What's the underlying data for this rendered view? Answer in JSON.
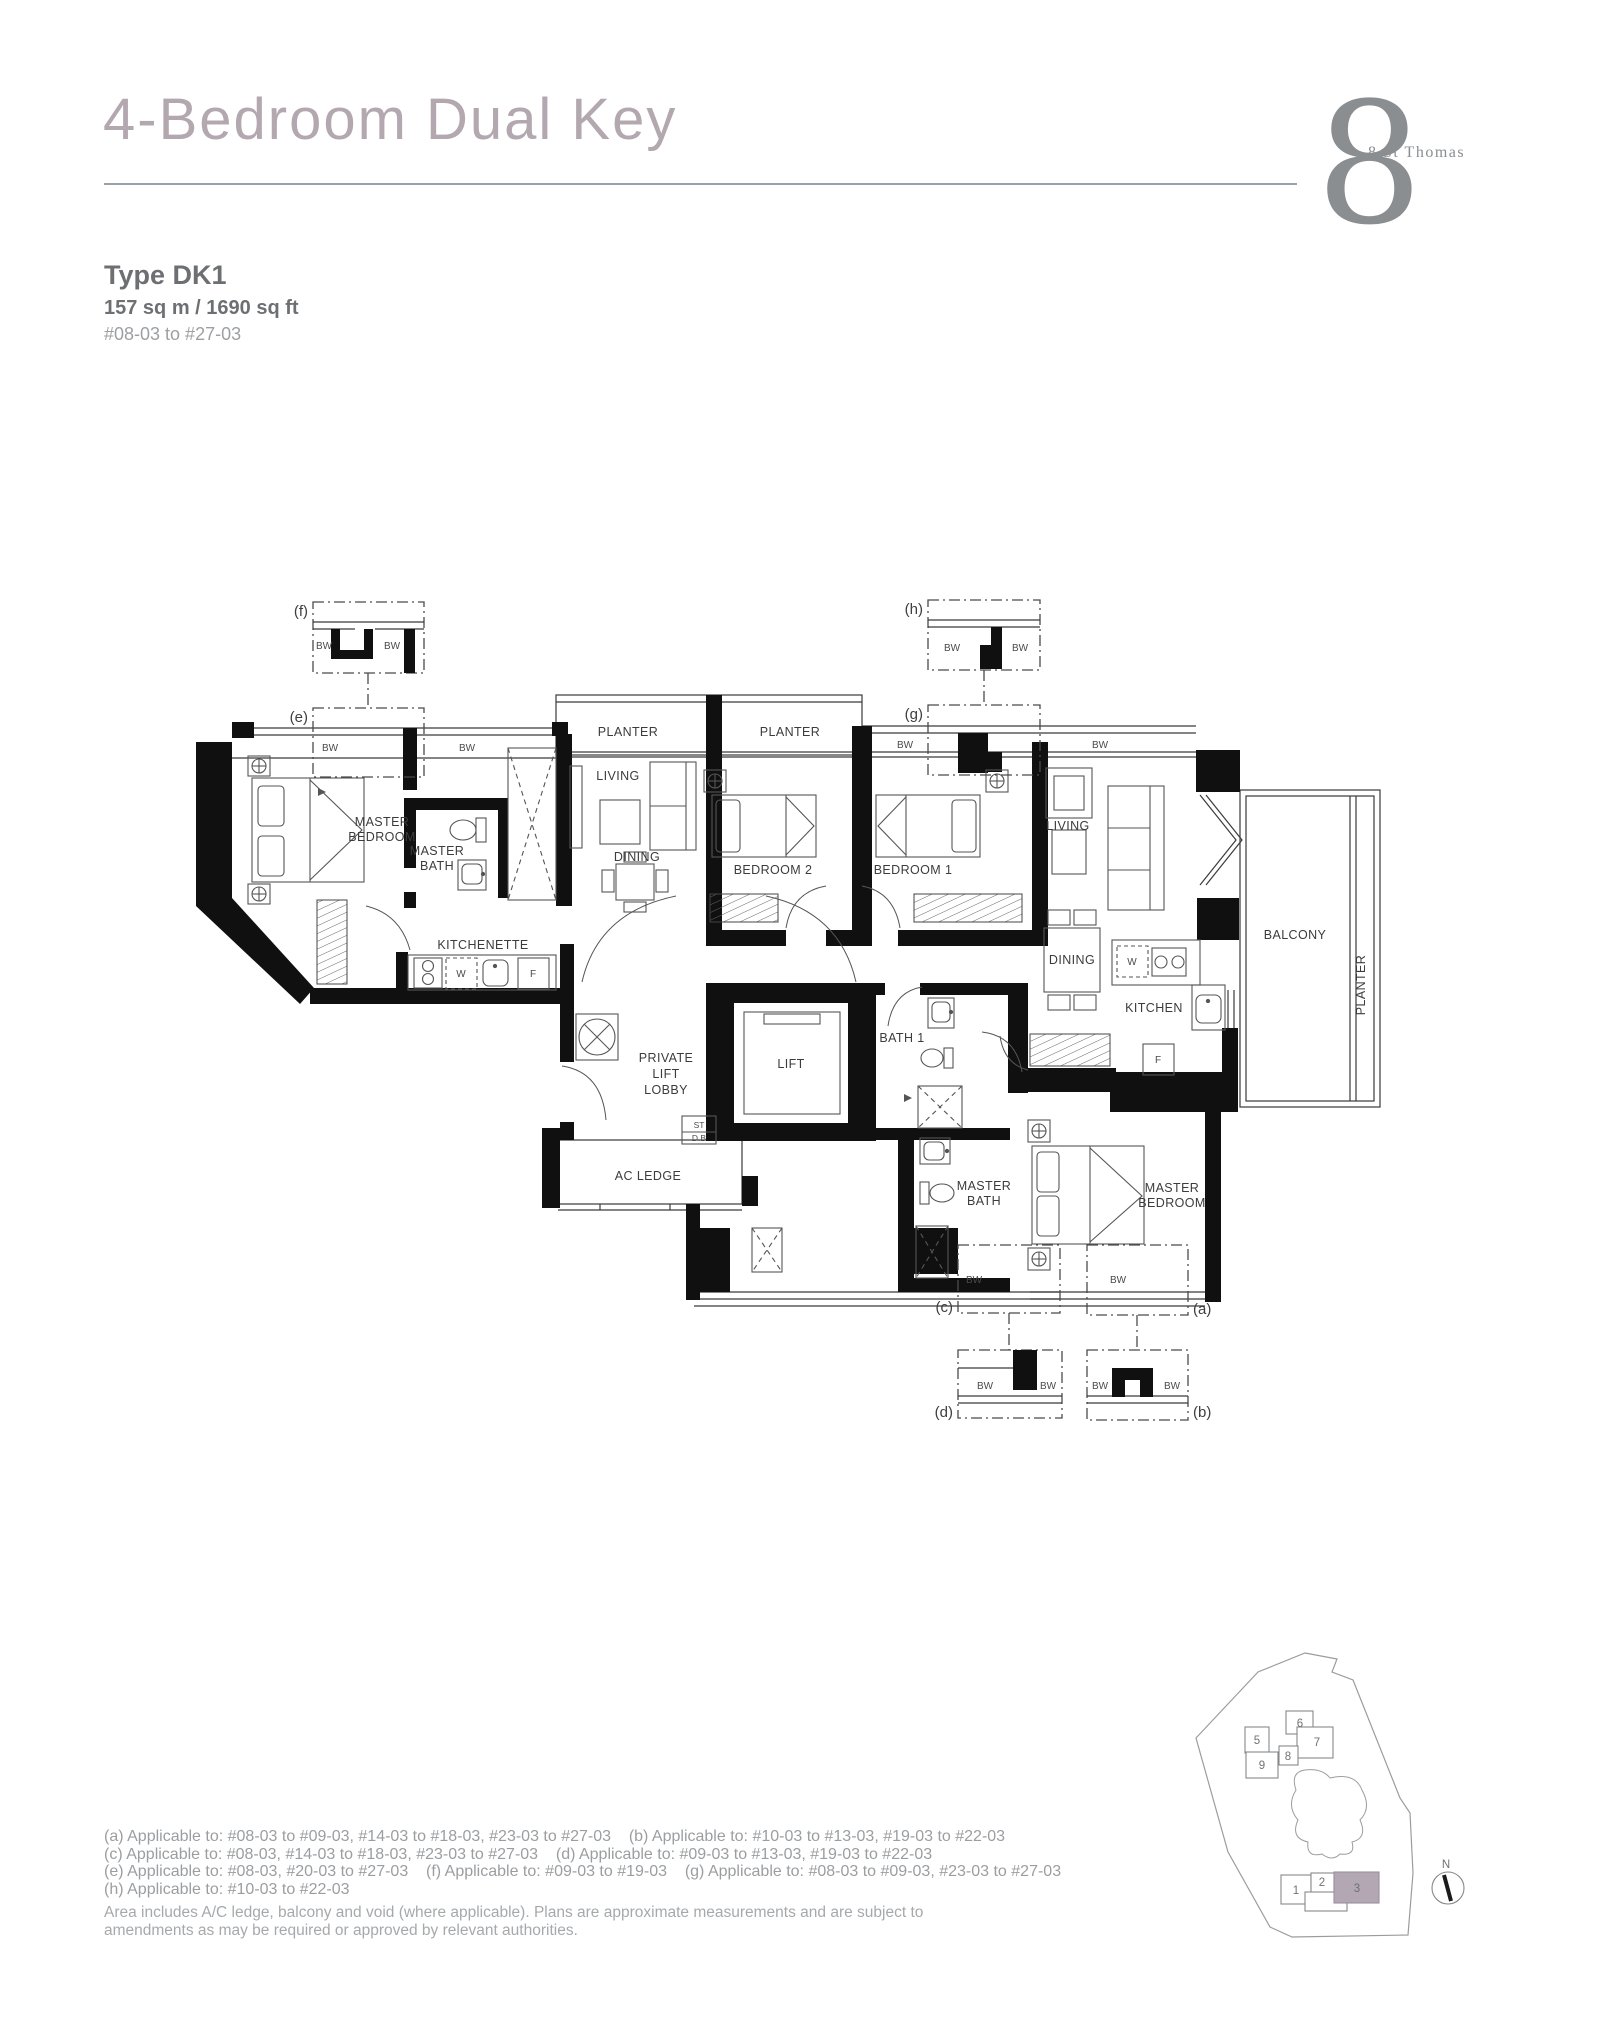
{
  "colors": {
    "title": "#b3a8b0",
    "brand": "#8a8e91",
    "text_dark": "#6d7073",
    "text_light": "#9b9ea1",
    "highlight": "#b2a7b2"
  },
  "header": {
    "title": "4-Bedroom Dual Key",
    "brand": {
      "numeral": "8",
      "name": "8 St Thomas"
    }
  },
  "unit": {
    "type": "Type DK1",
    "area": "157 sq m / 1690 sq ft",
    "levels": "#08-03 to #27-03"
  },
  "floorplan": {
    "labels": {
      "master": "MASTER",
      "bedroom": "BEDROOM",
      "bath": "BATH",
      "living": "LIVING",
      "dining": "DINING",
      "kitchen": "KITCHEN",
      "kitchenette": "KITCHENETTE",
      "bedroom_1": "BEDROOM 1",
      "bedroom_2": "BEDROOM 2",
      "bath_1": "BATH 1",
      "balcony": "BALCONY",
      "planter": "PLANTER",
      "lift": "LIFT",
      "private": "PRIVATE",
      "lobby": "LOBBY",
      "ac_ledge": "AC LEDGE",
      "st": "ST",
      "db": "D.B",
      "bw": "BW",
      "washer": "W",
      "fridge": "F"
    },
    "callouts": {
      "a": "(a)",
      "b": "(b)",
      "c": "(c)",
      "d": "(d)",
      "e": "(e)",
      "f": "(f)",
      "g": "(g)",
      "h": "(h)"
    }
  },
  "footnotes": [
    "(a) Applicable to: #08-03 to #09-03, #14-03 to #18-03, #23-03 to #27-03    (b) Applicable to: #10-03 to #13-03, #19-03 to #22-03",
    "(c) Applicable to: #08-03, #14-03 to #18-03, #23-03 to #27-03    (d) Applicable to: #09-03 to #13-03, #19-03 to #22-03",
    "(e) Applicable to: #08-03, #20-03 to #27-03    (f) Applicable to: #09-03 to #19-03    (g) Applicable to: #08-03 to #09-03, #23-03 to #27-03",
    "(h) Applicable to: #10-03 to #22-03"
  ],
  "disclaimer": "Area includes A/C ledge, balcony and void (where applicable). Plans are approximate measurements and are subject to amendments as may be required or approved by relevant authorities.",
  "siteplan": {
    "buildings": {
      "b1": "1",
      "b2": "2",
      "b3": "3",
      "b5": "5",
      "b6": "6",
      "b7": "7",
      "b8": "8",
      "b9": "9"
    },
    "compass": "N"
  }
}
